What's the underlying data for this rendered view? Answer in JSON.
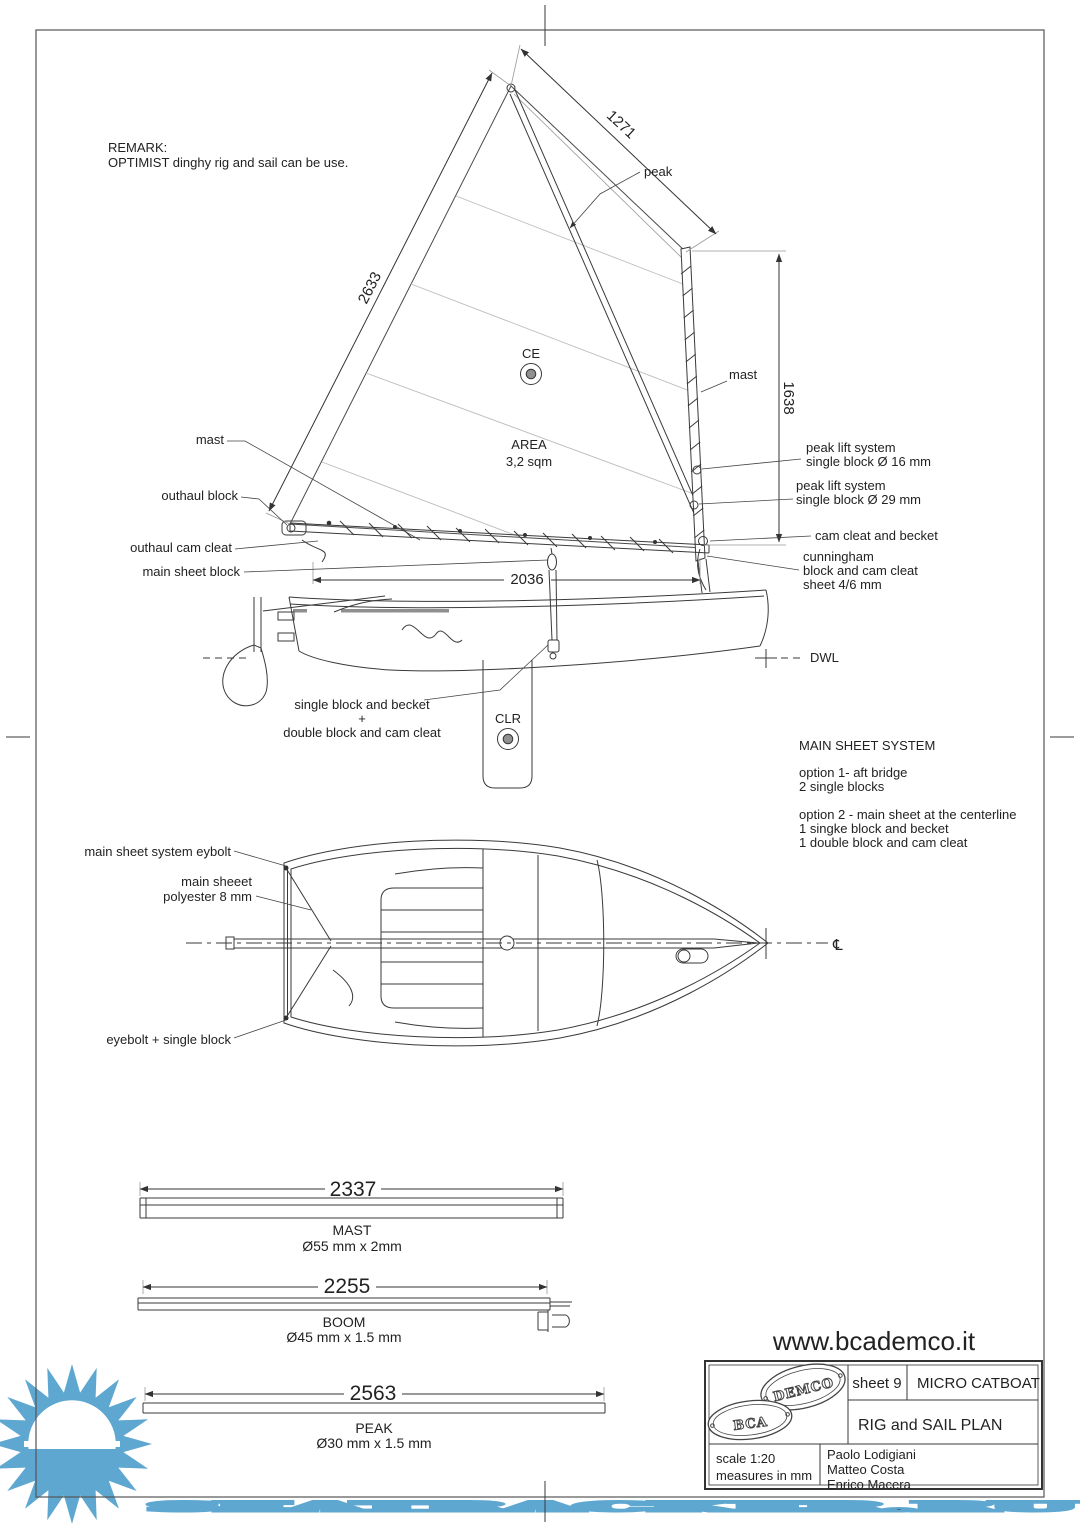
{
  "watermark": {
    "text": "SEATRACKER.RU",
    "color": "#5ea7d0"
  },
  "remark": {
    "title": "REMARK:",
    "body": "OPTIMIST dinghy rig and sail can be use."
  },
  "sail": {
    "ce": "CE",
    "area_title": "AREA",
    "area_value": "3,2 sqm",
    "peak": "peak",
    "mast": "mast",
    "dim_leech": "2633",
    "dim_head": "1271",
    "dim_mast": "1638",
    "dim_foot": "2036"
  },
  "callouts_left": {
    "mast": "mast",
    "outhaul_block": "outhaul block",
    "outhaul_cam_cleat": "outhaul cam cleat",
    "main_sheet_block": "main sheet block"
  },
  "callouts_right": {
    "peak_lift_1_l1": "peak lift system",
    "peak_lift_1_l2": "single block Ø 16 mm",
    "peak_lift_2_l1": "peak lift system",
    "peak_lift_2_l2": "single block Ø 29 mm",
    "cam_cleat_becket": "cam cleat and becket",
    "cunningham_l1": "cunningham",
    "cunningham_l2": "block and cam cleat",
    "cunningham_l3": "sheet 4/6 mm"
  },
  "hull_notes": {
    "block_note_l1": "single block and becket",
    "block_note_l2": "+",
    "block_note_l3": "double block and cam cleat",
    "clr": "CLR",
    "dwl": "DWL"
  },
  "main_sheet_system": {
    "title": "MAIN SHEET SYSTEM",
    "option1_l1": "option 1- aft bridge",
    "option1_l2": "2 single blocks",
    "option2_l1": "option 2 - main sheet at the centerline",
    "option2_l2": "1 singke block and becket",
    "option2_l3": "1 double block and cam cleat"
  },
  "plan_view": {
    "eybolt": "main sheet system eybolt",
    "sheet_l1": "main sheeet",
    "sheet_l2": "polyester 8 mm",
    "eyebolt_block": "eyebolt + single block",
    "centerline": "℄"
  },
  "spars": {
    "mast": {
      "length": "2337",
      "name": "MAST",
      "section": "Ø55 mm x 2mm"
    },
    "boom": {
      "length": "2255",
      "name": "BOOM",
      "section": "Ø45 mm x 1.5 mm"
    },
    "peak": {
      "length": "2563",
      "name": "PEAK",
      "section": "Ø30 mm x 1.5 mm"
    }
  },
  "footer": {
    "website": "www.bcademco.it"
  },
  "title_block": {
    "logo_top": "DEMCO",
    "logo_bottom": "BCA",
    "sheet": "sheet 9",
    "boat": "MICRO CATBOAT",
    "drawing": "RIG and SAIL PLAN",
    "scale": "scale 1:20",
    "units": "measures in mm",
    "authors": [
      "Paolo Lodigiani",
      "Matteo Costa",
      "Enrico Macera"
    ]
  }
}
